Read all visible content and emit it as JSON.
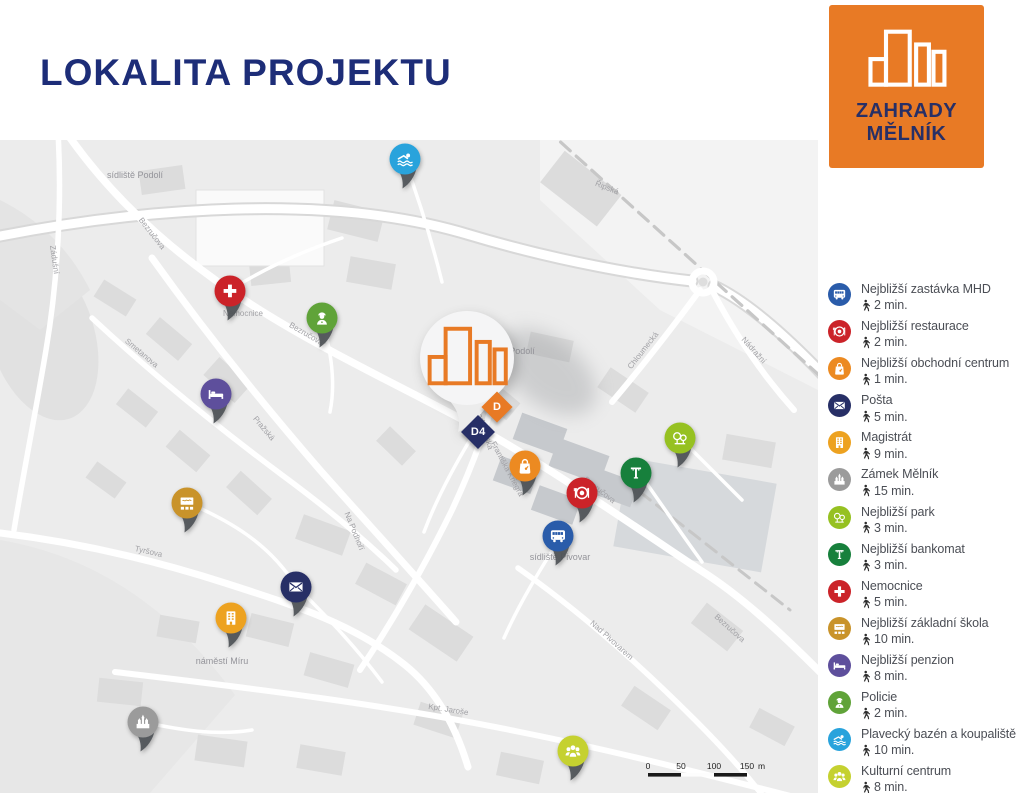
{
  "header": {
    "title": "LOKALITA PROJEKTU"
  },
  "logo": {
    "line1": "ZAHRADY",
    "line2": "MĚLNÍK",
    "bg_color": "#e87a25",
    "text_color": "#272f66"
  },
  "colors": {
    "accent_orange": "#e87a25",
    "navy": "#1d2d78"
  },
  "legend": {
    "items": [
      {
        "icon": "bus-icon",
        "color": "#2a5caa",
        "label": "Nejbližší zastávka MHD",
        "time": "2 min."
      },
      {
        "icon": "restaurant-icon",
        "color": "#cb2329",
        "label": "Nejbližší restaurace",
        "time": "2 min."
      },
      {
        "icon": "shopping-bag-icon",
        "color": "#ec8a21",
        "label": "Nejbližší obchodní centrum",
        "time": "1 min."
      },
      {
        "icon": "mail-icon",
        "color": "#272f66",
        "label": "Pošta",
        "time": "5 min."
      },
      {
        "icon": "office-building-icon",
        "color": "#eda220",
        "label": "Magistrát",
        "time": "9 min."
      },
      {
        "icon": "castle-icon",
        "color": "#9b9b9b",
        "label": "Zámek Mělník",
        "time": "15 min."
      },
      {
        "icon": "park-icon",
        "color": "#96c121",
        "label": "Nejbližší park",
        "time": "3 min."
      },
      {
        "icon": "atm-icon",
        "color": "#17803c",
        "label": "Nejbližší bankomat",
        "time": "3 min."
      },
      {
        "icon": "medical-cross-icon",
        "color": "#cb2329",
        "label": "Nemocnice",
        "time": "5 min."
      },
      {
        "icon": "school-icon",
        "color": "#c9932a",
        "label": "Nejbližší základní škola",
        "time": "10 min."
      },
      {
        "icon": "bed-icon",
        "color": "#5e4f9c",
        "label": "Nejbližší penzion",
        "time": "8 min."
      },
      {
        "icon": "police-icon",
        "color": "#60a339",
        "label": "Policie",
        "time": "2 min."
      },
      {
        "icon": "swimmer-icon",
        "color": "#29a3dc",
        "label": "Plavecký bazén a koupaliště",
        "time": "10 min."
      },
      {
        "icon": "people-icon",
        "color": "#c5d130",
        "label": "Kulturní centrum",
        "time": "8 min."
      }
    ]
  },
  "map": {
    "pins": [
      {
        "icon": "swimmer-icon",
        "color": "#29a3dc",
        "x": 405,
        "y": 19
      },
      {
        "icon": "medical-cross-icon",
        "color": "#cb2329",
        "x": 230,
        "y": 151
      },
      {
        "icon": "police-icon",
        "color": "#60a339",
        "x": 322,
        "y": 178
      },
      {
        "icon": "bed-icon",
        "color": "#5e4f9c",
        "x": 216,
        "y": 254
      },
      {
        "icon": "school-icon",
        "color": "#c9932a",
        "x": 187,
        "y": 363
      },
      {
        "icon": "mail-icon",
        "color": "#272f66",
        "x": 296,
        "y": 447
      },
      {
        "icon": "office-building-icon",
        "color": "#eda220",
        "x": 231,
        "y": 478
      },
      {
        "icon": "castle-icon",
        "color": "#9b9b9b",
        "x": 143,
        "y": 582
      },
      {
        "icon": "shopping-bag-icon",
        "color": "#ec8a21",
        "x": 525,
        "y": 326
      },
      {
        "icon": "restaurant-icon",
        "color": "#cb2329",
        "x": 582,
        "y": 353
      },
      {
        "icon": "bus-icon",
        "color": "#2a5caa",
        "x": 558,
        "y": 396
      },
      {
        "icon": "atm-icon",
        "color": "#17803c",
        "x": 636,
        "y": 333
      },
      {
        "icon": "park-icon",
        "color": "#96c121",
        "x": 680,
        "y": 298
      },
      {
        "icon": "people-icon",
        "color": "#c5d130",
        "x": 573,
        "y": 611
      }
    ],
    "project_markers": [
      {
        "label": "D",
        "color": "#e87a25",
        "x": 497,
        "y": 267,
        "size": 22
      },
      {
        "label": "D4",
        "color": "#272f66",
        "x": 478,
        "y": 292,
        "size": 24
      }
    ],
    "street_labels": [
      {
        "t": "Bezručova",
        "x": 150,
        "y": 95,
        "r": 52
      },
      {
        "t": "Bezručova",
        "x": 305,
        "y": 196,
        "r": 30
      },
      {
        "t": "Bezručova",
        "x": 598,
        "y": 352,
        "r": 38
      },
      {
        "t": "Bezručova",
        "x": 728,
        "y": 490,
        "r": 42
      },
      {
        "t": "Řipská",
        "x": 606,
        "y": 50,
        "r": 22
      },
      {
        "t": "Chloumecká",
        "x": 645,
        "y": 212,
        "r": -52
      },
      {
        "t": "Nádražní",
        "x": 752,
        "y": 212,
        "r": 48
      },
      {
        "t": "Vodárenská",
        "x": 482,
        "y": 290,
        "r": 72
      },
      {
        "t": "Pražská",
        "x": 262,
        "y": 290,
        "r": 50
      },
      {
        "t": "Smetanova",
        "x": 140,
        "y": 215,
        "r": 40
      },
      {
        "t": "Tyršova",
        "x": 148,
        "y": 414,
        "r": 13
      },
      {
        "t": "Zádušní",
        "x": 52,
        "y": 120,
        "r": 82
      },
      {
        "t": "Kpt. Jaroše",
        "x": 448,
        "y": 572,
        "r": 9
      },
      {
        "t": "Nad Pivovarem",
        "x": 610,
        "y": 502,
        "r": 42
      },
      {
        "t": "Na Podhoří",
        "x": 352,
        "y": 392,
        "r": 68
      },
      {
        "t": "Františka Kriegra",
        "x": 505,
        "y": 330,
        "r": 62
      },
      {
        "t": "náměstí Míru",
        "x": 222,
        "y": 524,
        "r": 0,
        "big": true
      },
      {
        "t": "sídliště Podolí",
        "x": 135,
        "y": 38,
        "r": 0,
        "big": true
      },
      {
        "t": "sídliště Pivovar",
        "x": 560,
        "y": 420,
        "r": 0,
        "big": true
      },
      {
        "t": "Podolí",
        "x": 522,
        "y": 214,
        "r": 0,
        "big": true
      },
      {
        "t": "Nemocnice",
        "x": 243,
        "y": 176,
        "r": 0
      }
    ],
    "scale": {
      "t0": "0",
      "t1": "50",
      "t2": "100",
      "t3": "150",
      "unit": "m"
    }
  }
}
